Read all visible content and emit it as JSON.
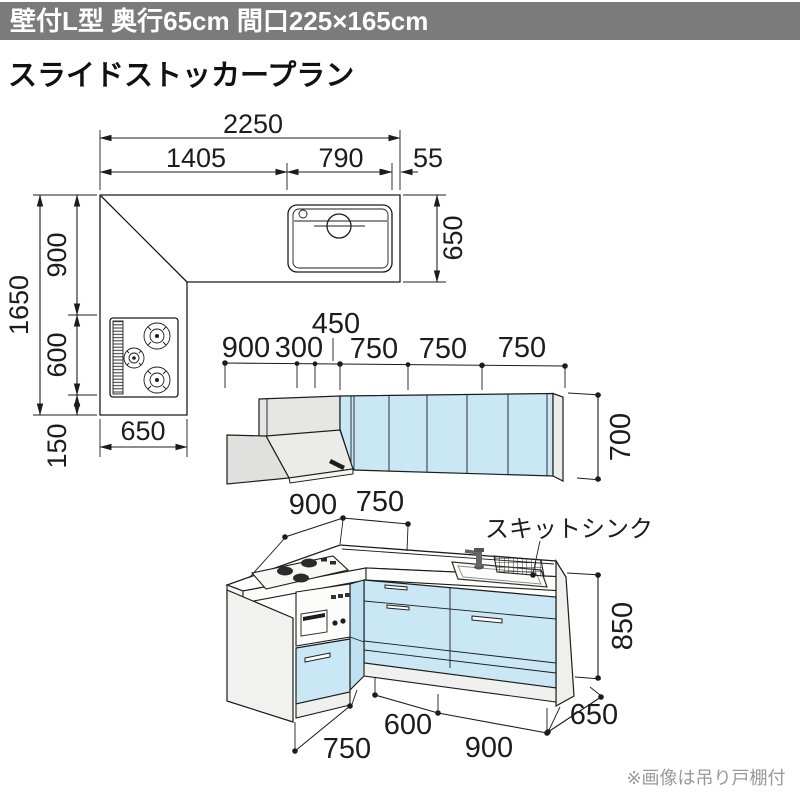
{
  "header": {
    "title": "壁付L型 奥行65cm 間口225×165cm"
  },
  "section": {
    "title": "スライドストッカープラン"
  },
  "plan": {
    "width_total": "2250",
    "width_left": "1405",
    "width_sink": "790",
    "width_end": "55",
    "depth_right": "650",
    "height_total": "1650",
    "height_upper": "900",
    "height_lower": "600",
    "height_end": "150",
    "width_bottom": "650"
  },
  "elevation": {
    "seg_900": "900",
    "seg_300": "300",
    "seg_450": "450",
    "seg_750a": "750",
    "seg_750b": "750",
    "seg_750c": "750",
    "height": "700"
  },
  "perspective": {
    "top_900": "900",
    "top_750": "750",
    "sink_label": "スキットシンク",
    "height": "850",
    "depth": "650",
    "front_600": "600",
    "front_900": "900",
    "left_750": "750"
  },
  "footnote": "※画像は吊り戸棚付",
  "colors": {
    "header_bg": "#7b7b7b",
    "cabinet_blue": "#c9e7f5",
    "line": "#1c1c1c",
    "note_gray": "#999999"
  }
}
